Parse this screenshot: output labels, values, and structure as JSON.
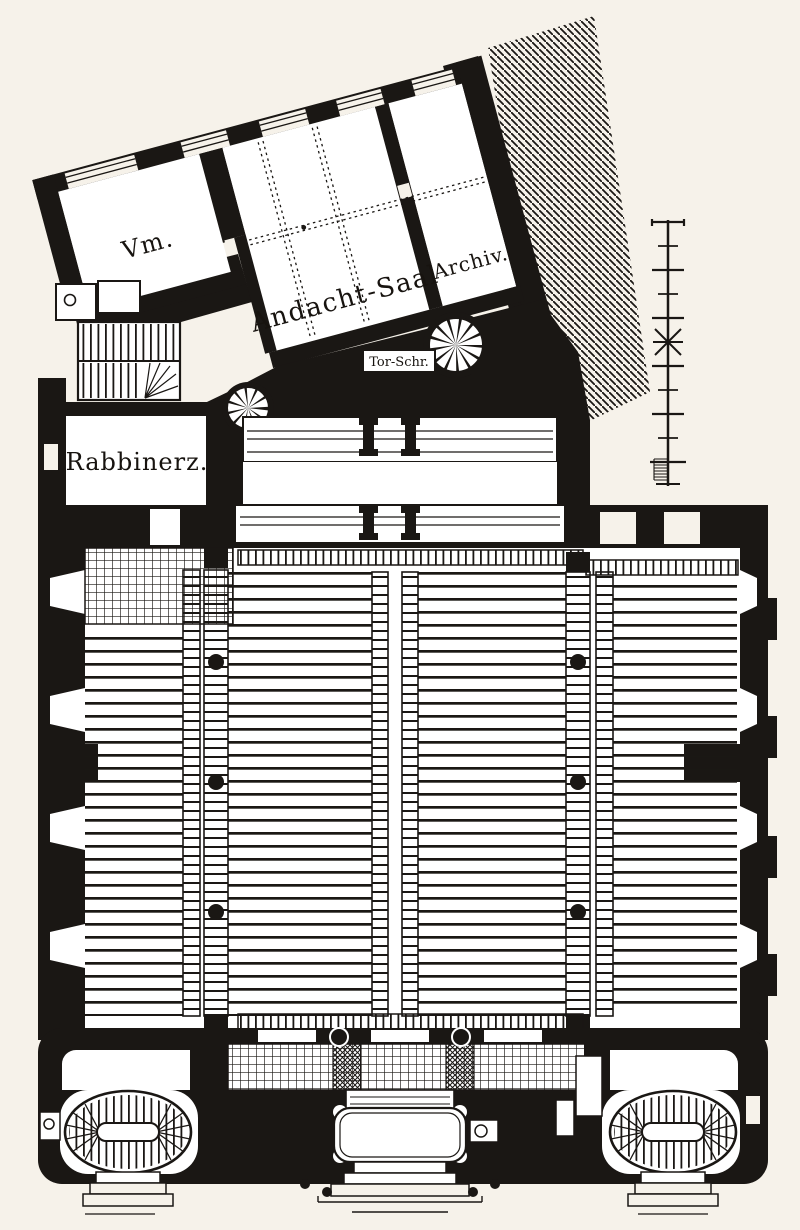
{
  "plan": {
    "kind": "engraved synagogue ground-floor plan",
    "rooms": {
      "vm": "Vm.",
      "andacht_saal": "Andacht-Saal",
      "archiv": "Archiv.",
      "rabbinerz": "Rabbinerz.",
      "tor_schr": "Tor-Schr."
    },
    "colors": {
      "ink": "#1a1714",
      "paper": "#f6f2ea"
    },
    "scale_bar": {
      "orientation": "vertical",
      "major_ticks": 11,
      "star_tick_index": 6,
      "fine_subdivisions": 8
    },
    "features": {
      "spiral_stairs": 2,
      "oval_stairs": 2,
      "nave_columns": 6,
      "wall_niches_per_side": 4
    }
  }
}
